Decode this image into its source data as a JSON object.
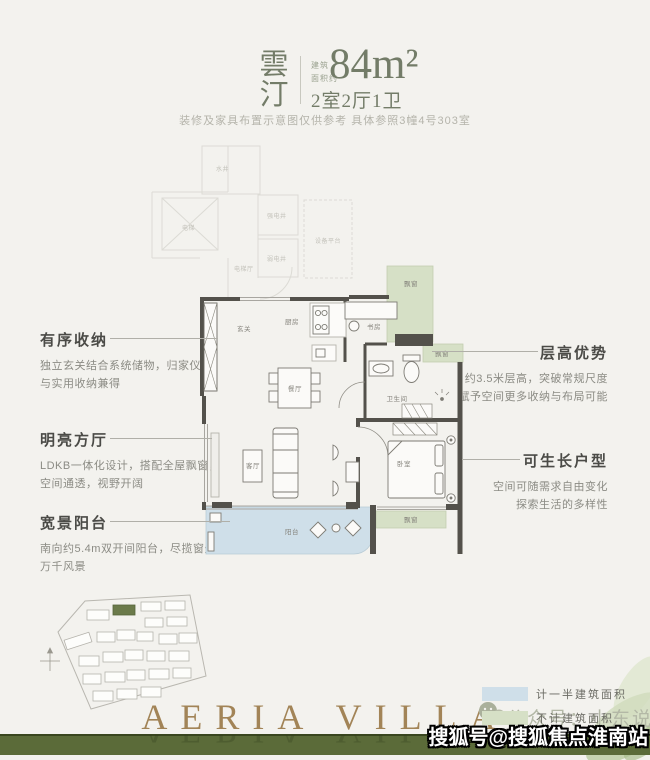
{
  "appearance": {
    "page_bg": "#f3f2ee",
    "title_green": "#737c68",
    "wall_color": "#53514b",
    "balcony_blue": "#cfdfe9",
    "bay_window_green": "#d6e0c6",
    "footer_band_green": "#5b6b39",
    "brand_gold": "#a28457",
    "site_highlight_green": "#6b7a4a"
  },
  "header": {
    "project_name": "雲汀",
    "area_prefix_1": "建筑",
    "area_prefix_2": "面积约",
    "area_value": "84m²",
    "unit_layout": "2室2厅1卫",
    "disclaimer": "装修及家具布置示意图仅供参考 具体参照3幢4号303室"
  },
  "annotations": {
    "left": [
      {
        "title": "有序收纳",
        "lines": [
          "独立玄关结合系统储物，归家仪式",
          "与实用收纳兼得"
        ]
      },
      {
        "title": "明亮方厅",
        "lines": [
          "LDKB一体化设计，搭配全屋飘窗，",
          "空间通透，视野开阔"
        ]
      },
      {
        "title": "宽景阳台",
        "lines": [
          "南向约5.4m双开间阳台，尽揽窗外",
          "万千风景"
        ]
      }
    ],
    "right": [
      {
        "title": "层高优势",
        "lines": [
          "约3.5米层高，突破常规尺度",
          "赋予空间更多收纳与布局可能"
        ]
      },
      {
        "title": "可生长户型",
        "lines": [
          "空间可随需求自由变化",
          "探索生活的多样性"
        ]
      }
    ]
  },
  "plan": {
    "rooms": {
      "entry": "玄关",
      "kitchen": "厨房",
      "dining": "餐厅",
      "study": "书房",
      "living": "客厅",
      "bathroom": "卫生间",
      "bedroom": "卧室",
      "balcony": "阳台",
      "bay_window": "飘窗"
    },
    "common": {
      "water_well": "水井",
      "elevator": "电梯",
      "elevator_hall": "电梯厅",
      "strong_elec": "强电井",
      "weak_elec": "弱电井",
      "equip_platform": "设备平台"
    }
  },
  "legend": {
    "items": [
      {
        "label": "计一半建筑面积",
        "color": "#cfdfe9"
      },
      {
        "label": "不计建筑面积",
        "color": "#d6e0c6"
      }
    ]
  },
  "footer": {
    "brand": "AERIA VILLA",
    "wechat_account": "公众号：小东说房"
  },
  "watermark": {
    "text": "搜狐号@搜狐焦点淮南站"
  }
}
